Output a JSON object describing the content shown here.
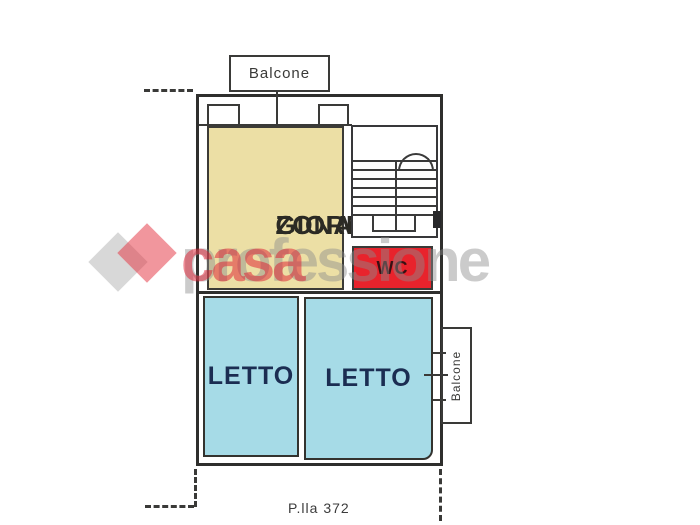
{
  "plan": {
    "type": "floor-plan",
    "balcony_top": {
      "label": "Balcone"
    },
    "balcony_right": {
      "label": "Balcone"
    },
    "rooms": {
      "zona_giorno": {
        "line1": "ZONA",
        "line2": "GIORNO",
        "fill": "#ecdfa5",
        "text_color": "#2b2a24"
      },
      "wc": {
        "label": "WC",
        "fill": "#e8232c",
        "text_color": "#381013"
      },
      "letto_left": {
        "label": "LETTO",
        "fill": "#a6dbe7",
        "text_color": "#1b2d52"
      },
      "letto_right": {
        "label": "LETTO",
        "fill": "#a6dbe7",
        "text_color": "#1b2d52"
      }
    },
    "stairwell": {
      "name": "stairwell",
      "treads": 7
    },
    "parcel_label": "P.lla 372",
    "wall_color": "#2f2f2d"
  },
  "watermark": {
    "text_gray": "professione",
    "text_red": "casa",
    "gray_color": "#d9d9d9",
    "red_color": "#ef8b93",
    "logo": "two-overlapping-diamonds"
  }
}
